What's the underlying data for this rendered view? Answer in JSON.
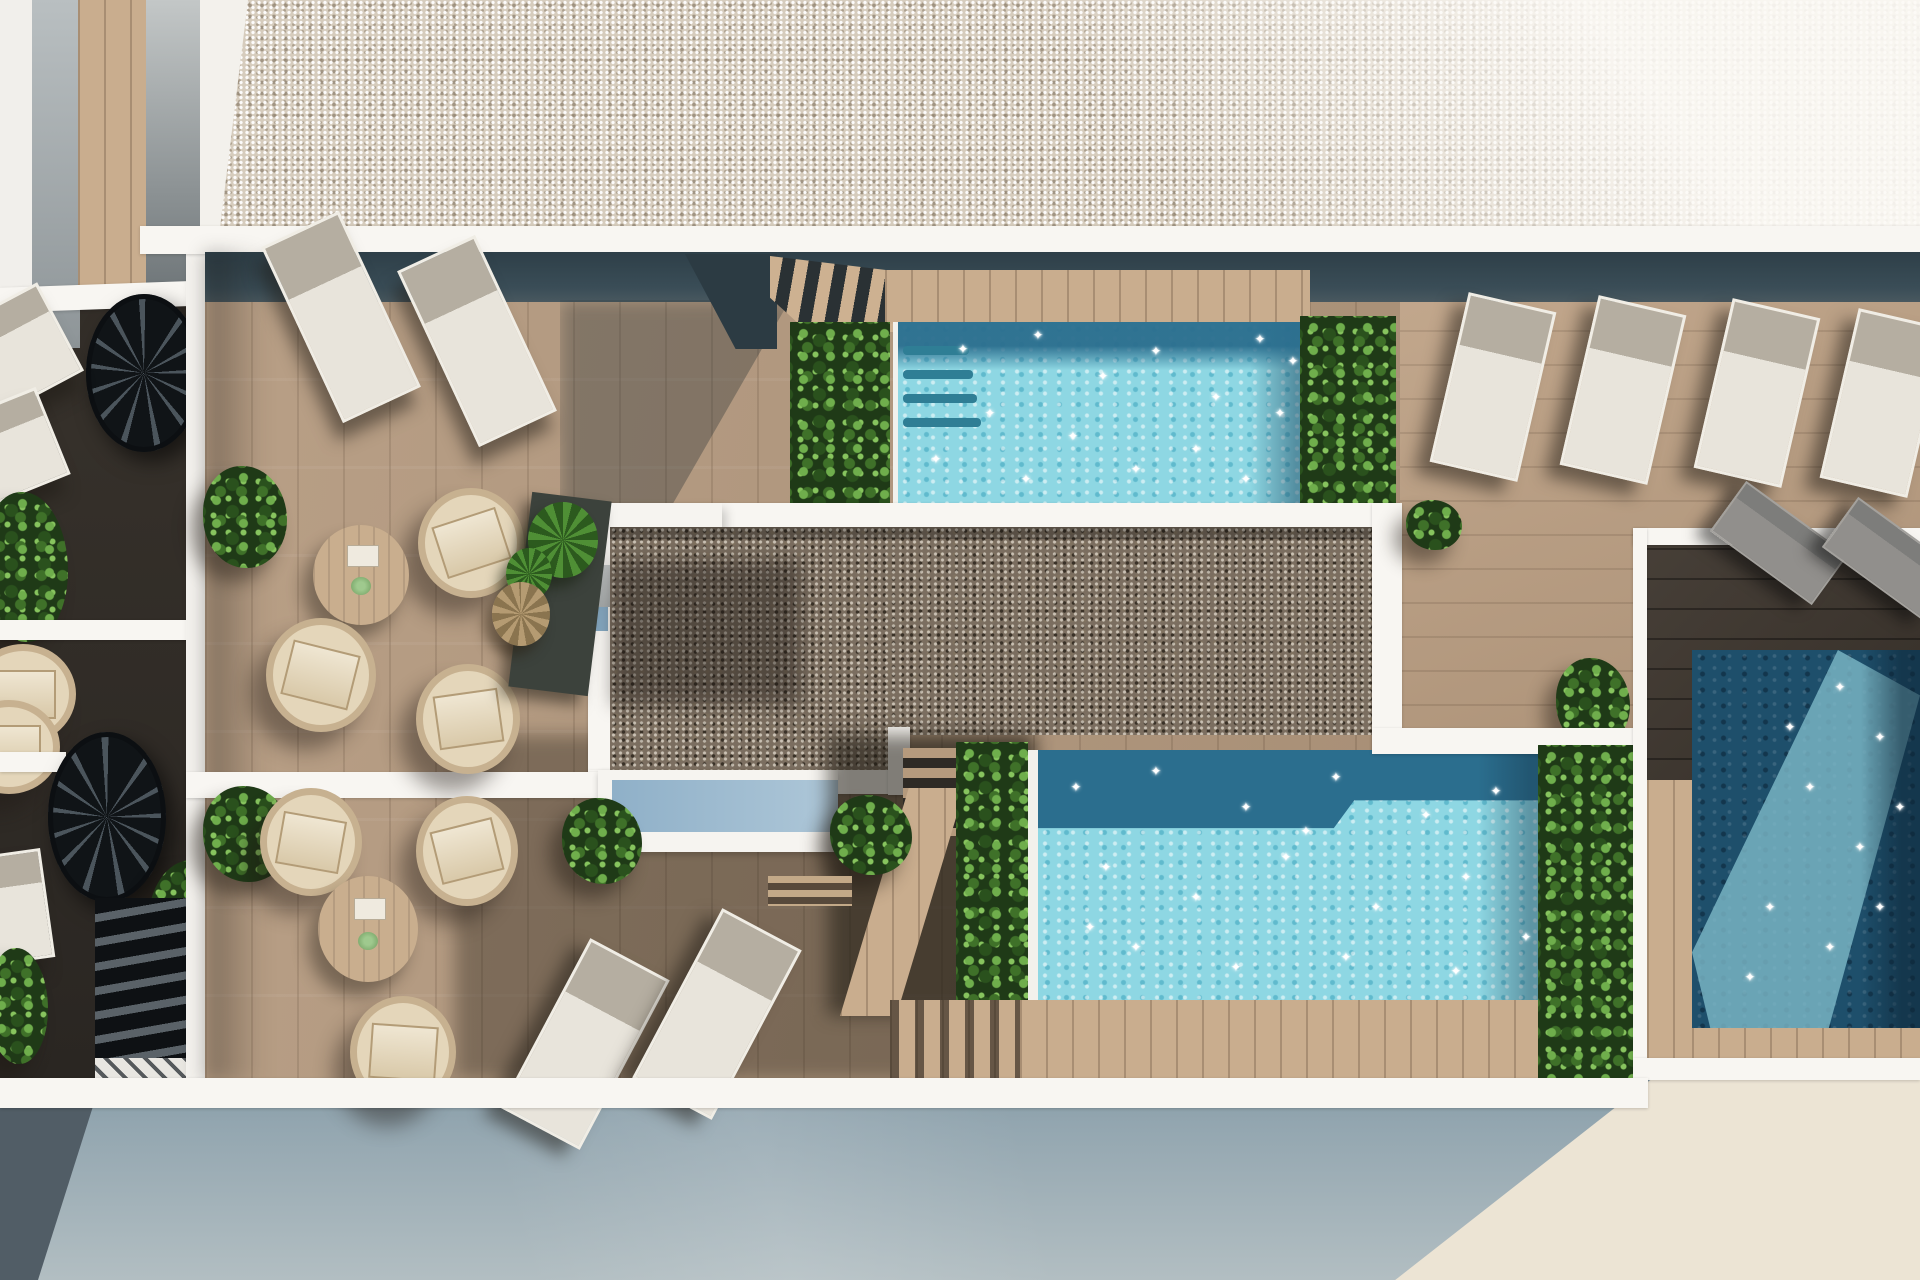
{
  "scene": {
    "type": "3d-architectural-render",
    "view": "top-down aerial",
    "subject": "Rooftop terrace of a residential building with three swimming pools, timber decking, gravel roof areas, sun loungers, round wicker chairs, coffee tables, spiral staircases and green planters; pale street at the bottom",
    "inventory": {
      "pools_turquoise": 2,
      "pools_dark_navy": 1,
      "white_sun_loungers": 8,
      "partial_edge_loungers": 4,
      "gray_sun_loungers": 2,
      "round_wicker_chairs": 6,
      "round_coffee_tables": 2,
      "spiral_staircases": 2,
      "planter_strips": 4,
      "bushes": 9,
      "agave_plants": 3
    }
  },
  "palette": {
    "gravel_light": "#d6ccbd",
    "gravel_dark": "#7b6e60",
    "deck_wood": "#b3987d",
    "deck_wood_right": "#bea184",
    "deck_wood_dark": "#3b332b",
    "slate_shadow_band": "#344851",
    "white_walkway": "#f8f6f2",
    "pool_light": "#8ed7e3",
    "pool_dark_band": "#2b6e8e",
    "pool_navy": "#1e4f6b",
    "pool_navy_light": "#7fbdcb",
    "foliage_mid": "#3f7129",
    "cushion": "#e9ddc6",
    "wicker": "#c7b190",
    "lounger_white": "#e8e4db",
    "lounger_head": "#b5aea1",
    "lounger_gray": "#918f8c",
    "street_blue_gray": "#8fa3ae",
    "street_pale": "#ece4d4",
    "skylight_blue": "#9fbcd1"
  },
  "decor": {
    "sparkle_glyph": "✦"
  },
  "sparkles": {
    "top_pool": [
      [
        65,
        28
      ],
      [
        140,
        14
      ],
      [
        205,
        55
      ],
      [
        258,
        30
      ],
      [
        318,
        76
      ],
      [
        362,
        18
      ],
      [
        92,
        92
      ],
      [
        175,
        115
      ],
      [
        238,
        148
      ],
      [
        298,
        128
      ],
      [
        382,
        92
      ],
      [
        38,
        138
      ],
      [
        128,
        158
      ],
      [
        348,
        158
      ],
      [
        395,
        40
      ]
    ],
    "center_pool": [
      [
        38,
        38
      ],
      [
        118,
        22
      ],
      [
        208,
        58
      ],
      [
        298,
        28
      ],
      [
        388,
        66
      ],
      [
        458,
        42
      ],
      [
        68,
        118
      ],
      [
        158,
        148
      ],
      [
        248,
        108
      ],
      [
        338,
        158
      ],
      [
        428,
        128
      ],
      [
        488,
        188
      ],
      [
        98,
        198
      ],
      [
        198,
        218
      ],
      [
        308,
        208
      ],
      [
        418,
        222
      ],
      [
        52,
        178
      ],
      [
        268,
        82
      ]
    ],
    "right_pool": [
      [
        148,
        38
      ],
      [
        188,
        88
      ],
      [
        118,
        138
      ],
      [
        168,
        198
      ],
      [
        78,
        258
      ],
      [
        138,
        298
      ],
      [
        58,
        328
      ],
      [
        188,
        258
      ],
      [
        98,
        78
      ],
      [
        208,
        158
      ]
    ]
  }
}
